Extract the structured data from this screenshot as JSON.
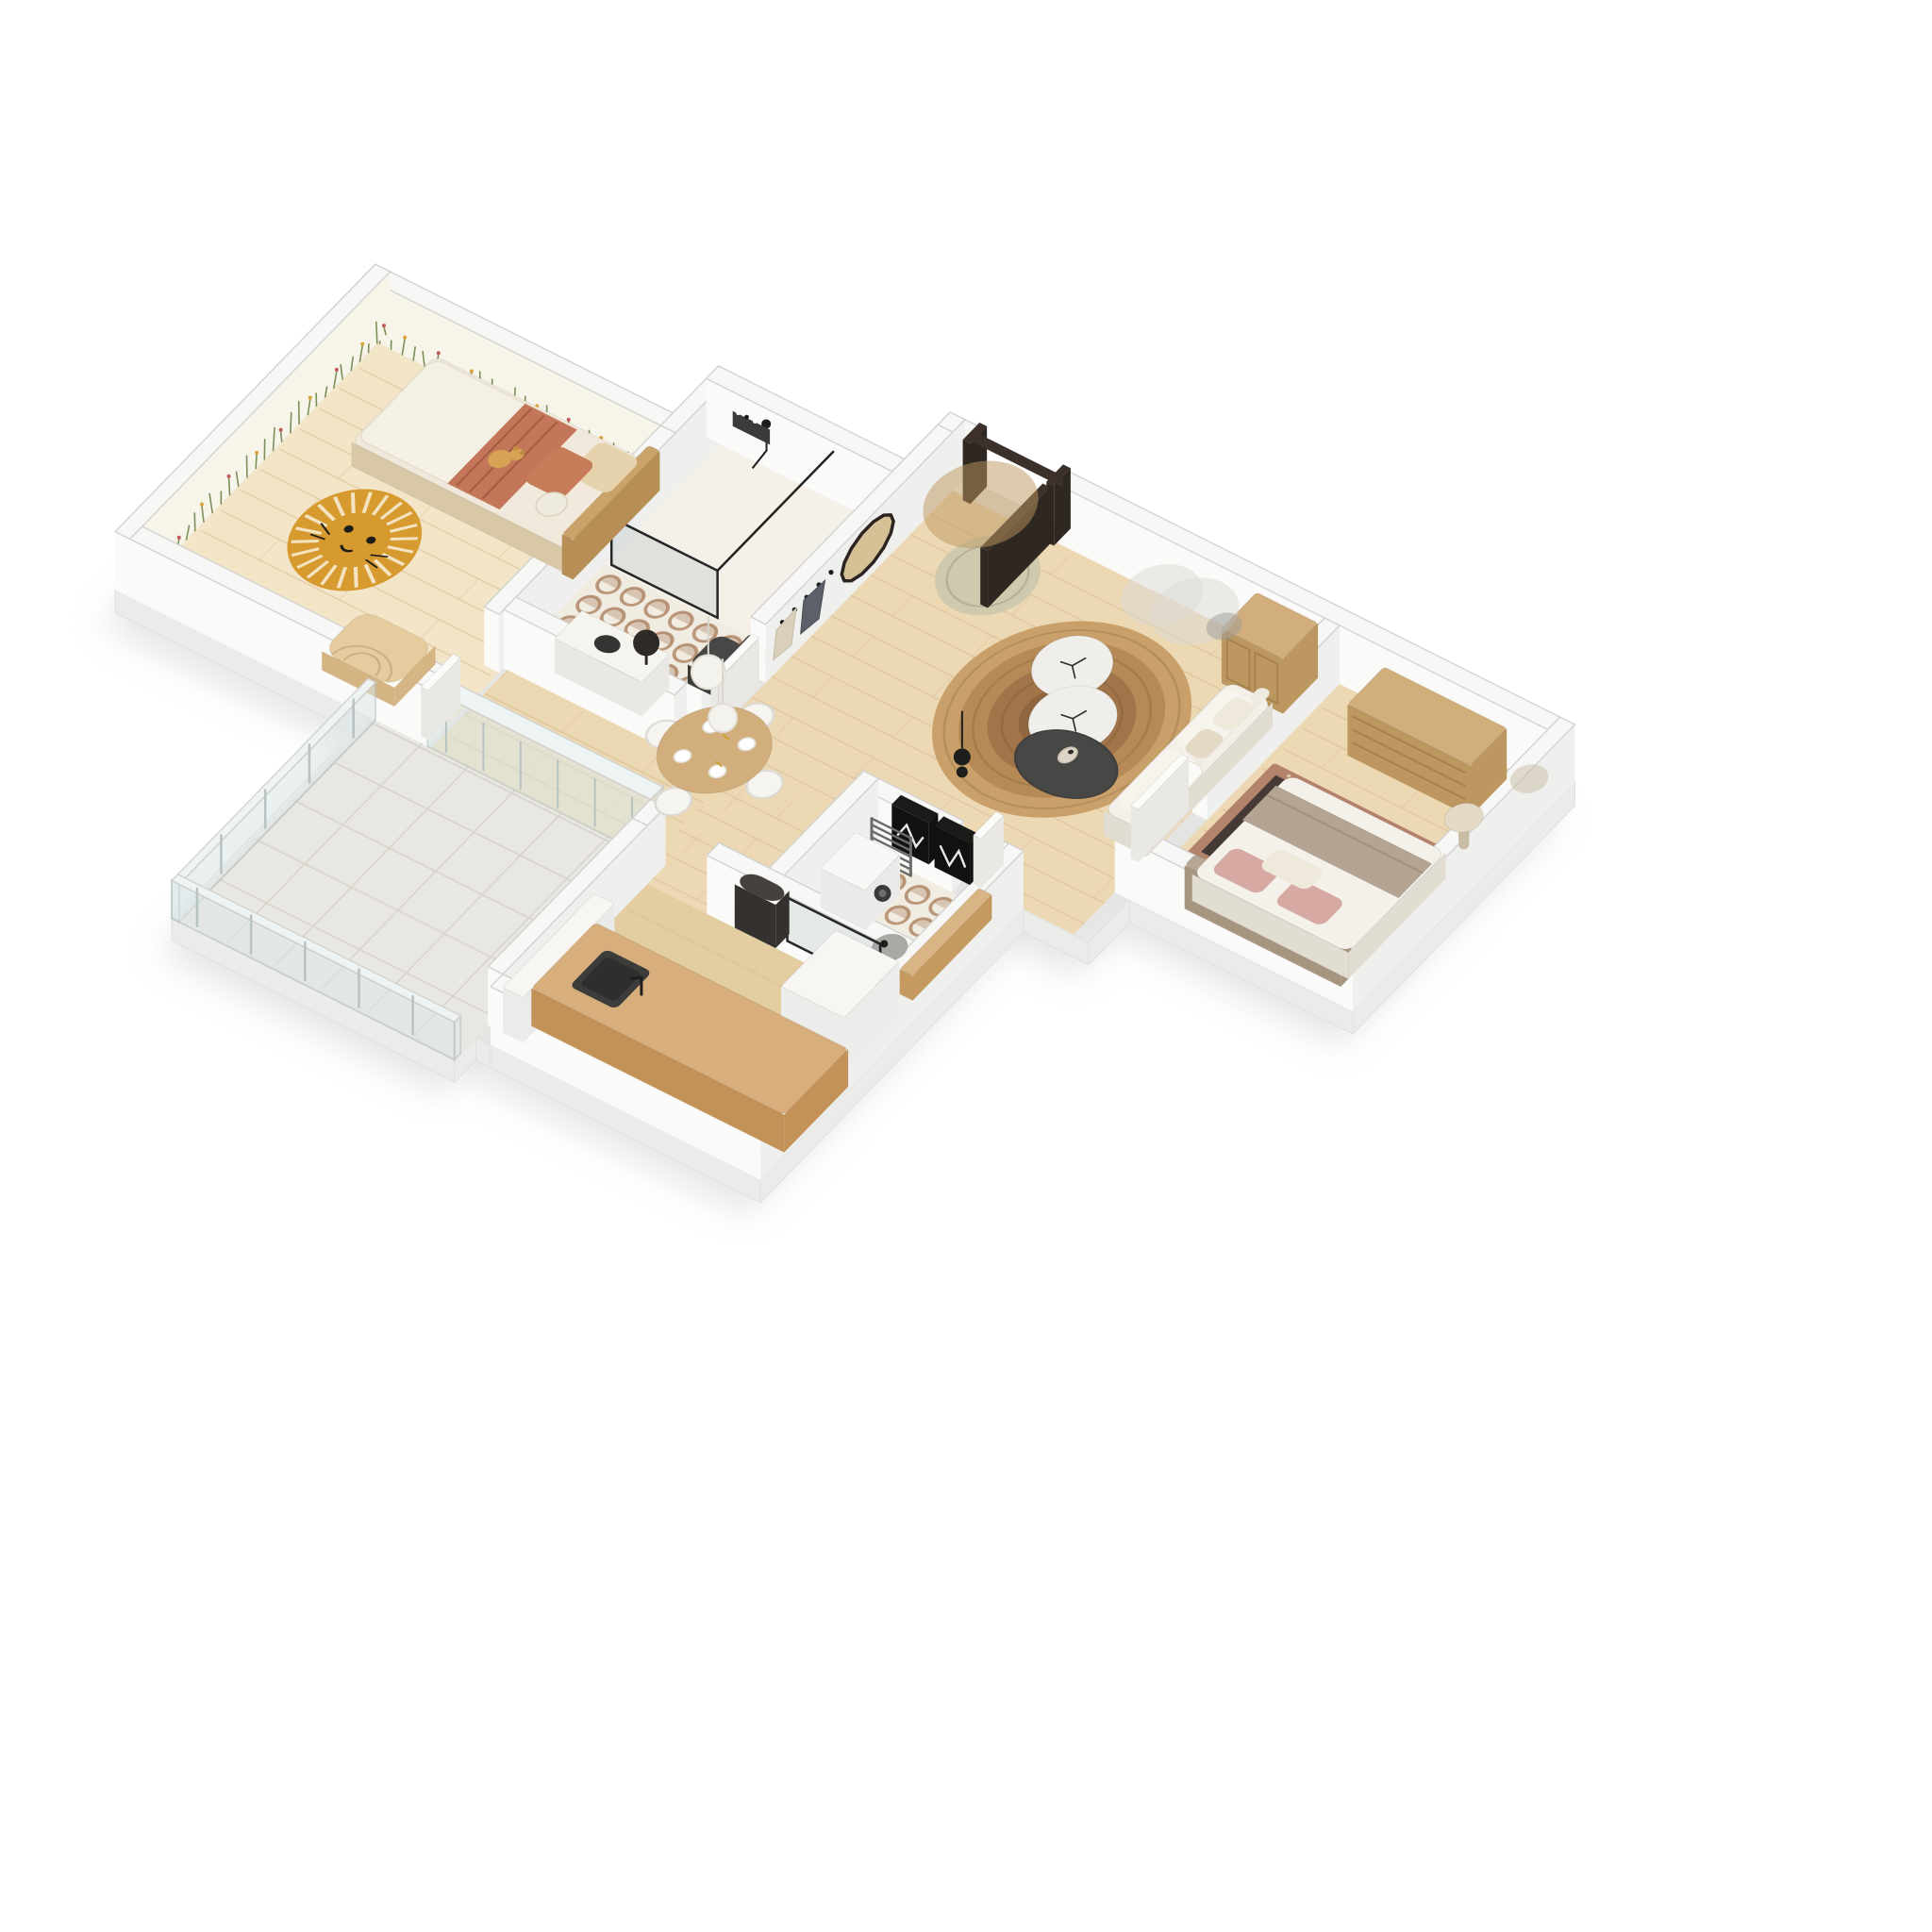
{
  "meta": {
    "description": "3D axonometric floor-plan rendering of a one-bedroom apartment with kids room, two bathrooms, kitchen and terrace",
    "background": "#ffffff"
  },
  "colors": {
    "bg": "#ffffff",
    "shadow": "#e2e2e0",
    "plinth": "#ebebe9",
    "wall_top": "#f7f7f5",
    "wall_edge": "#d2d2d0",
    "wall_face_x": "#efefed",
    "wall_face_y": "#fafaf8",
    "floor_wood": "#ecd9b4",
    "floor_wood_light": "#f3e6c8",
    "floor_wood_deep": "#e4cda1",
    "plank": "#d9bf96",
    "tile_base": "#f1ece2",
    "tile_light": "#f5f1e9",
    "tile_pattern": "#a87c58",
    "terrace": "#e9e7e1",
    "terrace_grid": "#d7d5cd",
    "glass": "#dde8e8",
    "glass_frame": "#b7c2c3",
    "mural_wall": "#f7f4ea",
    "mural_green": "#7d8f5a",
    "mural_red": "#c25a5a",
    "mural_yellow": "#d8a43c",
    "jute1": "#c9a06a",
    "jute2": "#b58a57",
    "jute3": "#a1744a",
    "jute4": "#8f6640",
    "sage_rug": "#cfc9ae",
    "lion": "#d79a2e",
    "lion_ray": "#f3e3c0",
    "persian_border": "#b4836c",
    "persian_field": "#453a35",
    "persian_motif": "#cf9d82",
    "persian_cream": "#e4d4bd",
    "oak": "#d2ae7c",
    "oak_dark": "#bd9760",
    "oak_edge": "#a6824f",
    "island": "#d8af7c",
    "island_side": "#c29258",
    "charcoal": "#474745",
    "charcoal_dark": "#3b3b39",
    "black": "#1d1d1b",
    "white_soft": "#f6f4ef",
    "white_side": "#e9e8e5",
    "cream": "#efe9dc",
    "sofa": "#f3f0e9",
    "sofa_side": "#e1ddd2",
    "terracotta": "#c47659",
    "terracotta_deep": "#a55c40",
    "beige_pillow": "#e7d2ae",
    "taupe": "#b3a493",
    "headboard": "#b7a795",
    "blush": "#d6aaa2",
    "marble": "#efeeea",
    "marble_stroke": "#dcdad4",
    "steel": "#6b6b69",
    "gray_mid": "#9b9b97",
    "door_dark": "#3c312a",
    "door_dark2": "#2f2721",
    "door_white": "#fbfbf9",
    "coat_dark": "#5b6069",
    "coat_beige": "#d9cfba",
    "mirror_tan": "#d6c196",
    "vase": "#ddd6c8"
  },
  "rooms": [
    {
      "id": "living-dining-room",
      "label": "Living & dining room",
      "floor": "wood"
    },
    {
      "id": "bedroom",
      "label": "Bedroom",
      "floor": "wood"
    },
    {
      "id": "kids-bedroom",
      "label": "Kids bedroom",
      "floor": "wood"
    },
    {
      "id": "bathroom",
      "label": "Bathroom with walk-in shower",
      "floor": "patterned tile"
    },
    {
      "id": "shower-laundry-room",
      "label": "Shower & laundry room",
      "floor": "patterned tile"
    },
    {
      "id": "kitchen",
      "label": "Kitchen",
      "floor": "wood"
    },
    {
      "id": "terrace",
      "label": "Terrace",
      "floor": "stone tile"
    }
  ],
  "furniture": [
    {
      "id": "entry-door",
      "room": "living-dining-room",
      "label": "Entry door, dark frame, open leaf"
    },
    {
      "id": "oval-mirror",
      "room": "living-dining-room",
      "label": "Oval rattan mirror"
    },
    {
      "id": "coat-rack",
      "room": "living-dining-room",
      "label": "Coat hooks with two coats"
    },
    {
      "id": "entry-rug",
      "room": "living-dining-room",
      "label": "Round sage sisal rug"
    },
    {
      "id": "jute-rug",
      "room": "living-dining-room",
      "label": "Large round jute rug"
    },
    {
      "id": "armoire",
      "room": "living-dining-room",
      "label": "Oak cane-door cabinet"
    },
    {
      "id": "sofa",
      "room": "living-dining-room",
      "label": "White sofa with cushions and throw"
    },
    {
      "id": "coffee-tables",
      "room": "living-dining-room",
      "label": "Two white pebble tables and charcoal table with vase"
    },
    {
      "id": "art-frames",
      "room": "living-dining-room",
      "label": "Two black framed art prints"
    },
    {
      "id": "black-pendant",
      "room": "living-dining-room",
      "label": "Black double-sphere pendant lamp"
    },
    {
      "id": "dining-set",
      "room": "living-dining-room",
      "label": "Round oak dining table, white chairs, tableware, two white sphere pendants"
    },
    {
      "id": "dresser",
      "room": "bedroom",
      "label": "Oak six-drawer dresser"
    },
    {
      "id": "persian-rug",
      "room": "bedroom",
      "label": "Terracotta persian rug"
    },
    {
      "id": "double-bed",
      "room": "bedroom",
      "label": "Double bed, white duvet, taupe throw, blush pillows"
    },
    {
      "id": "side-table",
      "room": "bedroom",
      "label": "Round side table"
    },
    {
      "id": "bedroom-door",
      "room": "bedroom",
      "label": "White door"
    },
    {
      "id": "kids-bed",
      "room": "kids-bedroom",
      "label": "Rattan bed, boucle duvet, terracotta blanket"
    },
    {
      "id": "teddy-bear",
      "room": "kids-bedroom",
      "label": "Teddy bear"
    },
    {
      "id": "lion-rug",
      "room": "kids-bedroom",
      "label": "Mustard lion-face rug"
    },
    {
      "id": "toy-arch",
      "room": "kids-bedroom",
      "label": "Wooden arch toy"
    },
    {
      "id": "kids-door",
      "room": "kids-bedroom",
      "label": "White door"
    },
    {
      "id": "walk-in-shower",
      "room": "bathroom",
      "label": "Black-framed walk-in shower with niche"
    },
    {
      "id": "toilet",
      "room": "bathroom",
      "label": "Charcoal wall-hung toilet"
    },
    {
      "id": "vanity",
      "room": "bathroom",
      "label": "Vanity with black basin and round mirror"
    },
    {
      "id": "towel-radiator-1",
      "room": "bathroom",
      "label": "Black towel radiator"
    },
    {
      "id": "bathroom-door",
      "room": "bathroom",
      "label": "White door"
    },
    {
      "id": "towel-radiator-2",
      "room": "shower-laundry-room",
      "label": "Gray towel radiator"
    },
    {
      "id": "washing-machine",
      "room": "shower-laundry-room",
      "label": "Washing machine"
    },
    {
      "id": "pedestal-basin",
      "room": "shower-laundry-room",
      "label": "Gray pedestal basin"
    },
    {
      "id": "wood-shelf",
      "room": "shower-laundry-room",
      "label": "Oak shelf ledge"
    },
    {
      "id": "shower-screen",
      "room": "shower-laundry-room",
      "label": "Black-framed shower screen"
    },
    {
      "id": "laundry-door",
      "room": "shower-laundry-room",
      "label": "White door"
    },
    {
      "id": "kitchen-island",
      "room": "kitchen",
      "label": "Oak counter with charcoal sink and black tap"
    },
    {
      "id": "tall-cabinet",
      "room": "kitchen",
      "label": "White tall cabinet"
    },
    {
      "id": "low-cabinet",
      "room": "kitchen",
      "label": "White low cabinet"
    },
    {
      "id": "arched-panel",
      "room": "kitchen",
      "label": "Dark arched panel"
    },
    {
      "id": "glass-balustrade",
      "room": "terrace",
      "label": "Glass balustrade"
    }
  ]
}
